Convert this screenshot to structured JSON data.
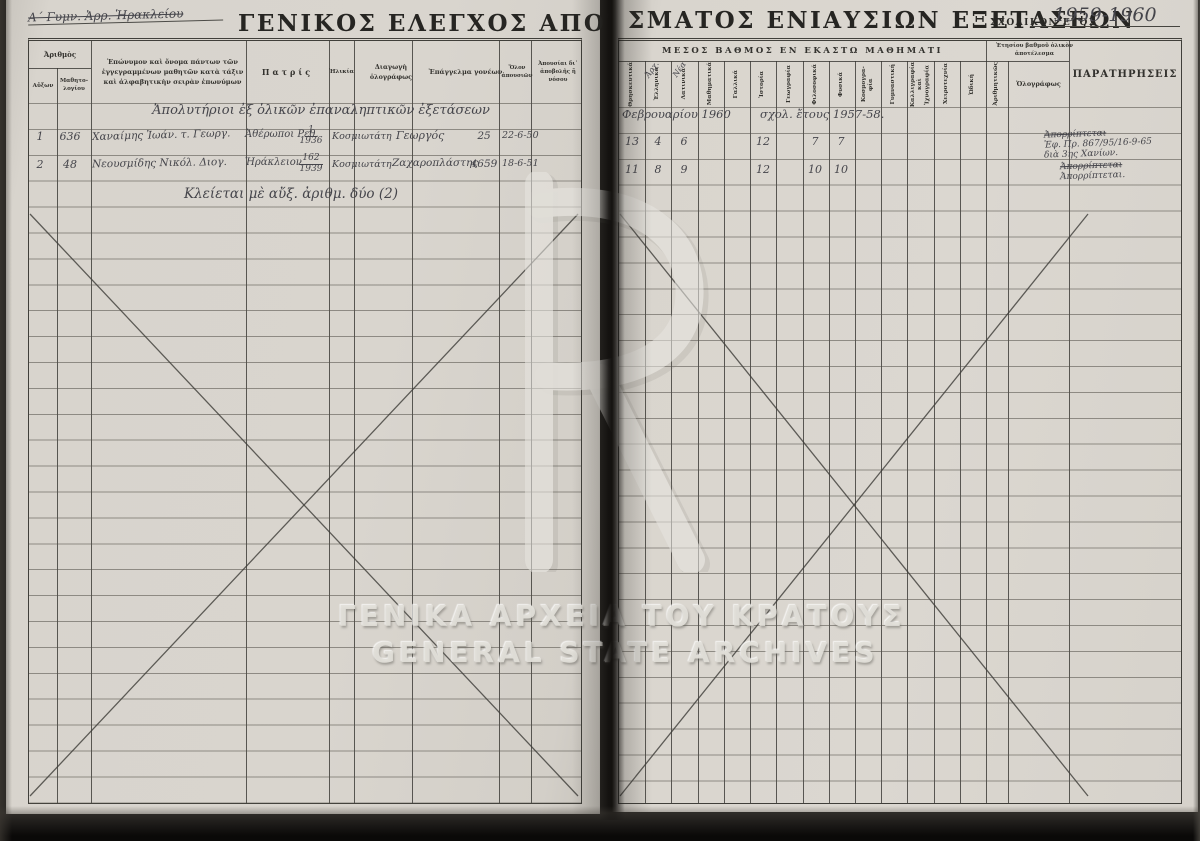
{
  "colors": {
    "paper": "#d8d4cd",
    "rule_line": "#3f3e3a",
    "print_ink": "#2c2b28",
    "handwriting_ink": "#45454b",
    "watermark": "#e2dfd9",
    "scanner_bg": "#141311"
  },
  "document": {
    "title_left_main": "ΓΕΝΙΚΟΣ ΕΛΕΓΧΟΣ ΑΠΟΤΕΛ",
    "title_left_cont": "Ε",
    "title_right": "ΣΜΑΤΟΣ ΕΝΙΑΥΣΙΩΝ ΕΞΕΤΑΣΕΩΝ",
    "school_year_label": "ΣΧΟΛΙΚΟΝ ΕΤΟΣ",
    "school_year_value": "1959-1960",
    "top_note": "Α΄ Γυμν. Ἀρρ. Ἡρακλείου"
  },
  "watermark": {
    "line1": "ΓΕΝΙΚΑ ΑΡΧΕΙΑ ΤΟΥ ΚΡΑΤΟΥΣ",
    "line2": "GENERAL STATE ARCHIVES",
    "emblem_letter": "R"
  },
  "left_table": {
    "headers": {
      "arithmos": "Ἀριθμὸς",
      "auxon": "Αὔξων",
      "mathitologiou": "Μαθητο- λογίου",
      "name": "Ἐπώνυμον καὶ ὄνομα πάντων τῶν ἐγγεγραμμένων μαθητῶν κατὰ τάξιν καὶ ἀλφαβητικὴν σειρὰν ἐπωνύμων",
      "patris": "Πατρίς",
      "ilikia": "Ἡλικία",
      "diagogi": "Διαγωγὴ ὁλογράφως",
      "epangelma": "Ἐπάγγελμα γονέων",
      "olai_apousiai": "Ὅλον ἀπουσιῶν",
      "apousiai_apovolis": "Ἀπουσίαι δι᾽ ἀποβολῆς ἢ νόσου"
    },
    "section_note": "Ἀπολυτήριοι ἐξ ὁλικῶν ἐπαναληπτικῶν ἐξετάσεων",
    "rows": [
      {
        "auxon": "1",
        "mathitologiou": "636",
        "name": "Χαναίμης Ἰωάν. τ. Γεωργ.",
        "patris": "Ἀθέρωποι Ρεθ.",
        "ilikia_num": "1",
        "ilikia_year": "1936",
        "diagogi": "Κοσμιωτάτη",
        "epangelma": "Γεωργός",
        "olai": "25",
        "apousiai": "22-6-50"
      },
      {
        "auxon": "2",
        "mathitologiou": "48",
        "name": "Νεουσμίδης Νικόλ. Διογ.",
        "patris": "Ἡράκλειον",
        "ilikia_num": "162",
        "ilikia_year": "1939",
        "diagogi": "Κοσμιωτάτη",
        "epangelma": "Ζαχαροπλάστης",
        "olai": "4659",
        "apousiai": "18-6-51"
      }
    ],
    "closing_note": "Κλείεται μὲ αὔξ. ἀριθμ. δύο (2)"
  },
  "right_table": {
    "group_header": "ΜΕΣΟΣ ΒΑΘΜΟΣ ΕΝ ΕΚΑΣΤΩ ΜΑΘΗΜΑΤΙ",
    "subjects": [
      "Θρησκευτικά",
      "Ἑλληνικά",
      "Λατινικά",
      "Μαθηματικά",
      "Γαλλικά",
      "Ἱστορία",
      "Γεωγραφία",
      "Φιλοσοφικά",
      "Φυσικά",
      "Κοσμογρα-φία",
      "Γυμναστική",
      "Καλλιγραφία καὶ Ἰχνογραφία",
      "Χειροτεχνία",
      "Ὠδική"
    ],
    "subject_annotation_ellinika": "Ἀρχ.",
    "subject_annotation_latinika": "Νέα",
    "annual_group": "Ἐτησίου βαθμοῦ ὁλικὸν ἀποτέλεσμα",
    "arithmitikos": "Ἀριθμητικῶς",
    "olografos": "Ὁλογράφως",
    "paratiriseis": "ΠΑΡΑΤΗΡΗΣΕΙΣ",
    "session_note": "Φεβρουαρίου 1960        σχολ. ἔτους 1957-58.",
    "grades_row1": [
      "13",
      "4",
      "6",
      "",
      "",
      "12",
      "",
      "7",
      "7",
      "",
      "",
      "",
      "",
      ""
    ],
    "grades_row2": [
      "11",
      "8",
      "9",
      "",
      "",
      "12",
      "",
      "10",
      "10",
      "",
      "",
      "",
      "",
      ""
    ],
    "remarks_row1": {
      "line1": "Ἀπορρίπτεται",
      "line2": "Ἐφ. Πρ. 867/95/16-9-65",
      "line3": "διὰ 3ης Χανίων."
    },
    "remarks_row2": {
      "line1": "Ἀπορρίπτεται",
      "line2": "Ἀπορρίπτεται."
    }
  }
}
